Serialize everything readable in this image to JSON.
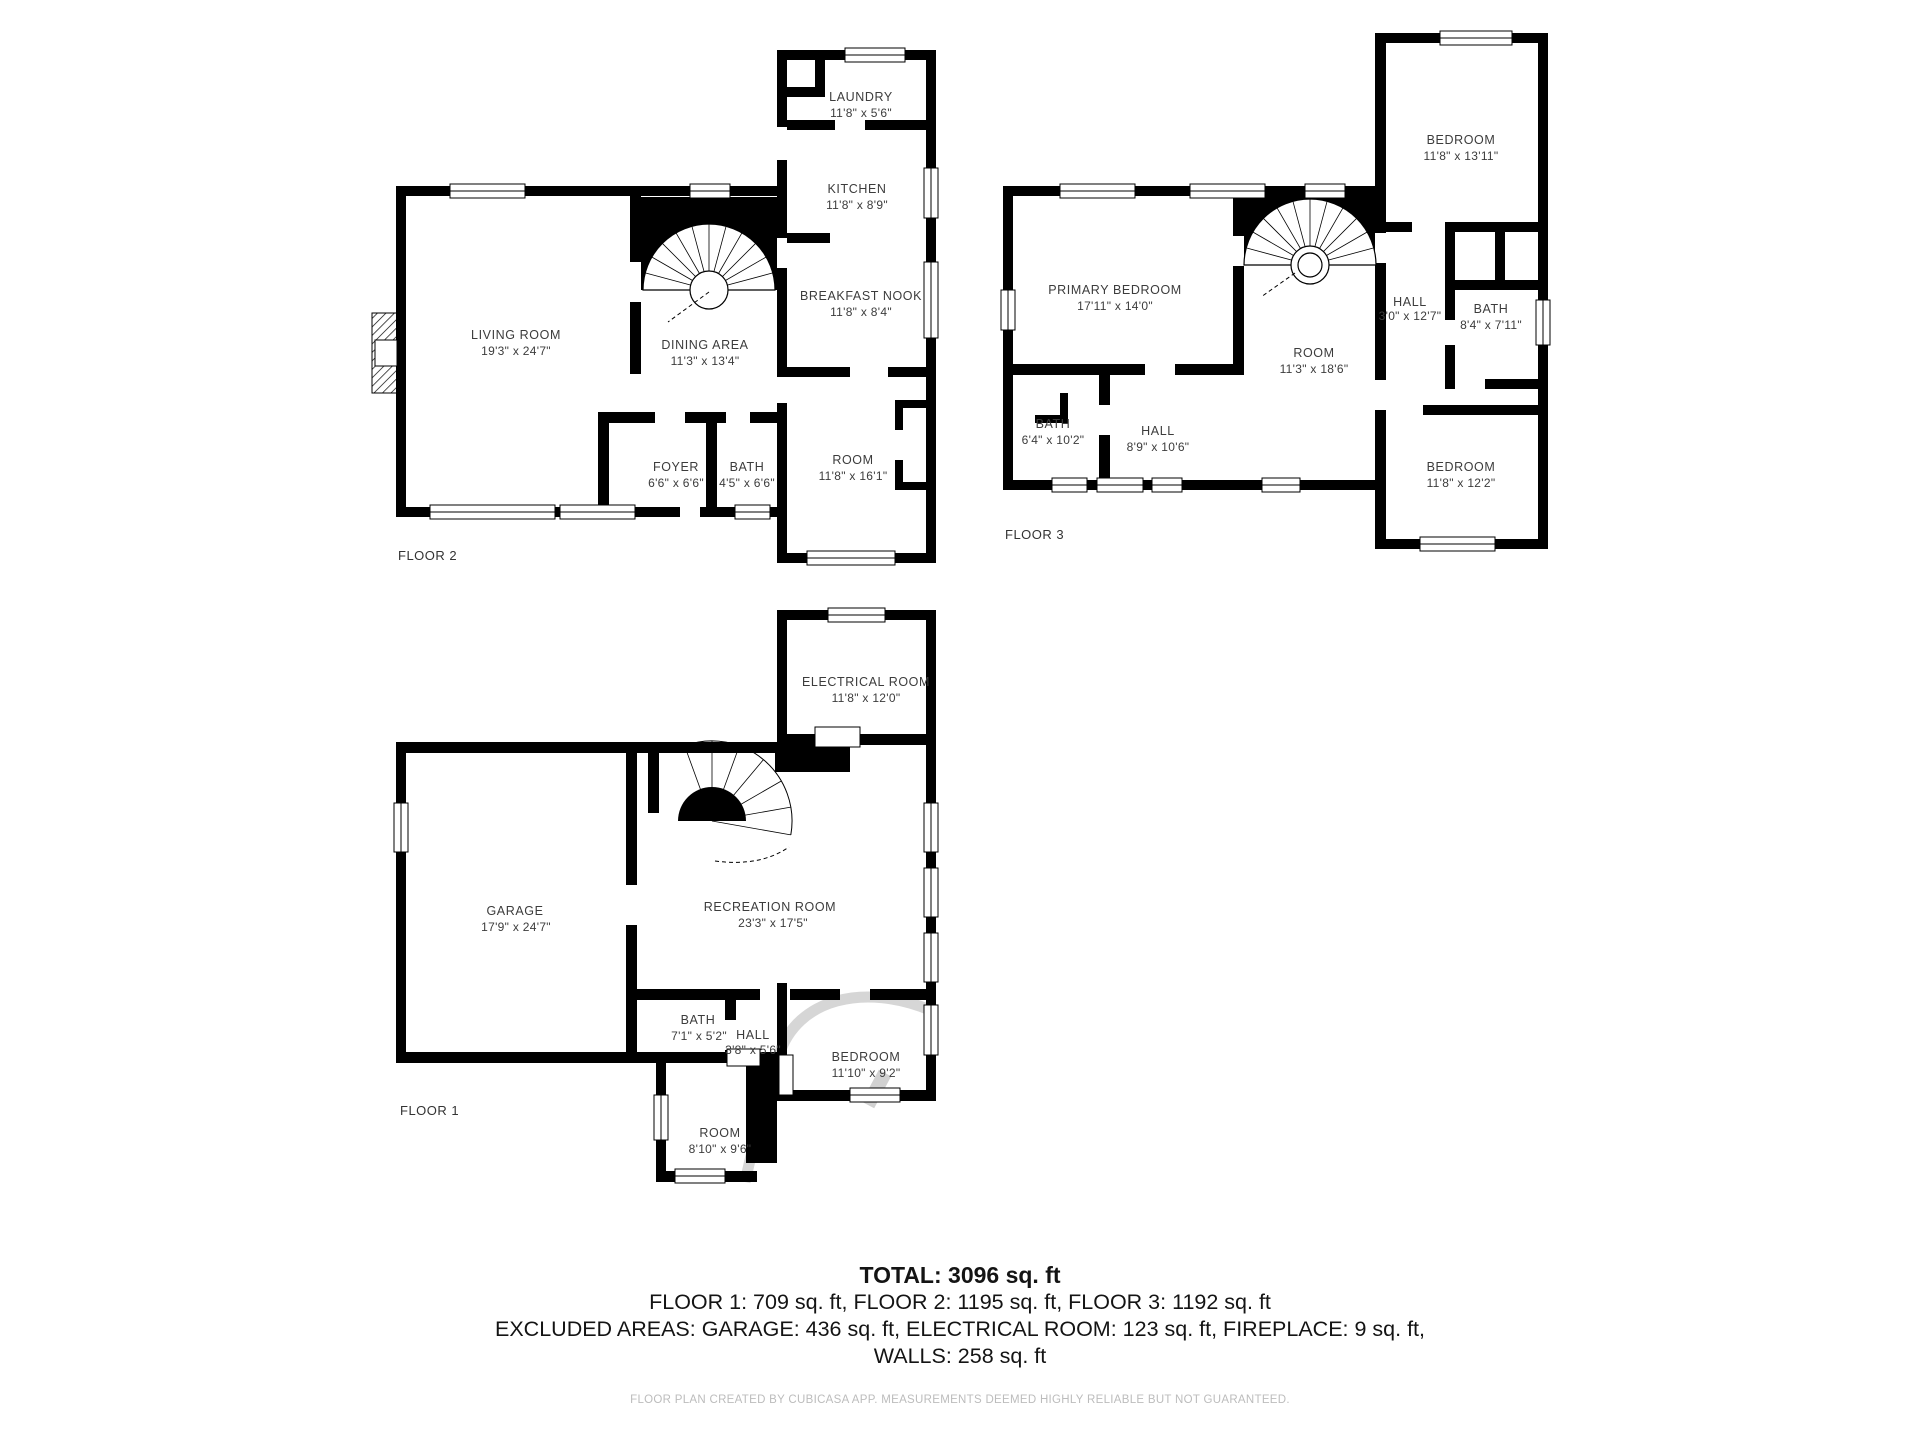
{
  "colors": {
    "wall": "#000000",
    "room_label": "#3c3c3c",
    "summary_text": "#141414",
    "footer_text": "#bcbcbc",
    "background": "#ffffff"
  },
  "floors": [
    {
      "label": "FLOOR 2",
      "rooms": {
        "living_room": {
          "name": "LIVING ROOM",
          "dims": "19'3\" x 24'7\""
        },
        "dining_area": {
          "name": "DINING AREA",
          "dims": "11'3\" x 13'4\""
        },
        "foyer": {
          "name": "FOYER",
          "dims": "6'6\" x 6'6\""
        },
        "bath": {
          "name": "BATH",
          "dims": "4'5\" x 6'6\""
        },
        "laundry": {
          "name": "LAUNDRY",
          "dims": "11'8\" x 5'6\""
        },
        "kitchen": {
          "name": "KITCHEN",
          "dims": "11'8\" x 8'9\""
        },
        "breakfast_nook": {
          "name": "BREAKFAST NOOK",
          "dims": "11'8\" x 8'4\""
        },
        "room": {
          "name": "ROOM",
          "dims": "11'8\" x 16'1\""
        }
      }
    },
    {
      "label": "FLOOR 3",
      "rooms": {
        "primary_bedroom": {
          "name": "PRIMARY BEDROOM",
          "dims": "17'11\" x 14'0\""
        },
        "bedroom_top": {
          "name": "BEDROOM",
          "dims": "11'8\" x 13'11\""
        },
        "hall_upper": {
          "name": "HALL",
          "dims": "3'0\" x 12'7\""
        },
        "bath_upper": {
          "name": "BATH",
          "dims": "8'4\" x 7'11\""
        },
        "room": {
          "name": "ROOM",
          "dims": "11'3\" x 18'6\""
        },
        "bath_lower": {
          "name": "BATH",
          "dims": "6'4\" x 10'2\""
        },
        "hall_lower": {
          "name": "HALL",
          "dims": "8'9\" x 10'6\""
        },
        "bedroom_bottom": {
          "name": "BEDROOM",
          "dims": "11'8\" x 12'2\""
        }
      }
    },
    {
      "label": "FLOOR 1",
      "rooms": {
        "electrical_room": {
          "name": "ELECTRICAL ROOM",
          "dims": "11'8\" x 12'0\""
        },
        "garage": {
          "name": "GARAGE",
          "dims": "17'9\" x 24'7\""
        },
        "recreation_room": {
          "name": "RECREATION ROOM",
          "dims": "23'3\" x 17'5\""
        },
        "bath": {
          "name": "BATH",
          "dims": "7'1\" x 5'2\""
        },
        "hall": {
          "name": "HALL",
          "dims": "3'8\" x 5'6\""
        },
        "bedroom": {
          "name": "BEDROOM",
          "dims": "11'10\" x 9'2\""
        },
        "room": {
          "name": "ROOM",
          "dims": "8'10\" x 9'6\""
        }
      }
    }
  ],
  "summary": {
    "total": "TOTAL: 3096 sq. ft",
    "floors_line": "FLOOR 1: 709 sq. ft, FLOOR 2: 1195 sq. ft, FLOOR 3: 1192 sq. ft",
    "excluded_line": "EXCLUDED AREAS: GARAGE: 436 sq. ft, ELECTRICAL ROOM: 123 sq. ft, FIREPLACE: 9 sq. ft,",
    "walls_line": "WALLS: 258 sq. ft"
  },
  "footer": {
    "disclaimer": "FLOOR PLAN CREATED BY CUBICASA APP. MEASUREMENTS DEEMED HIGHLY RELIABLE BUT NOT GUARANTEED."
  }
}
